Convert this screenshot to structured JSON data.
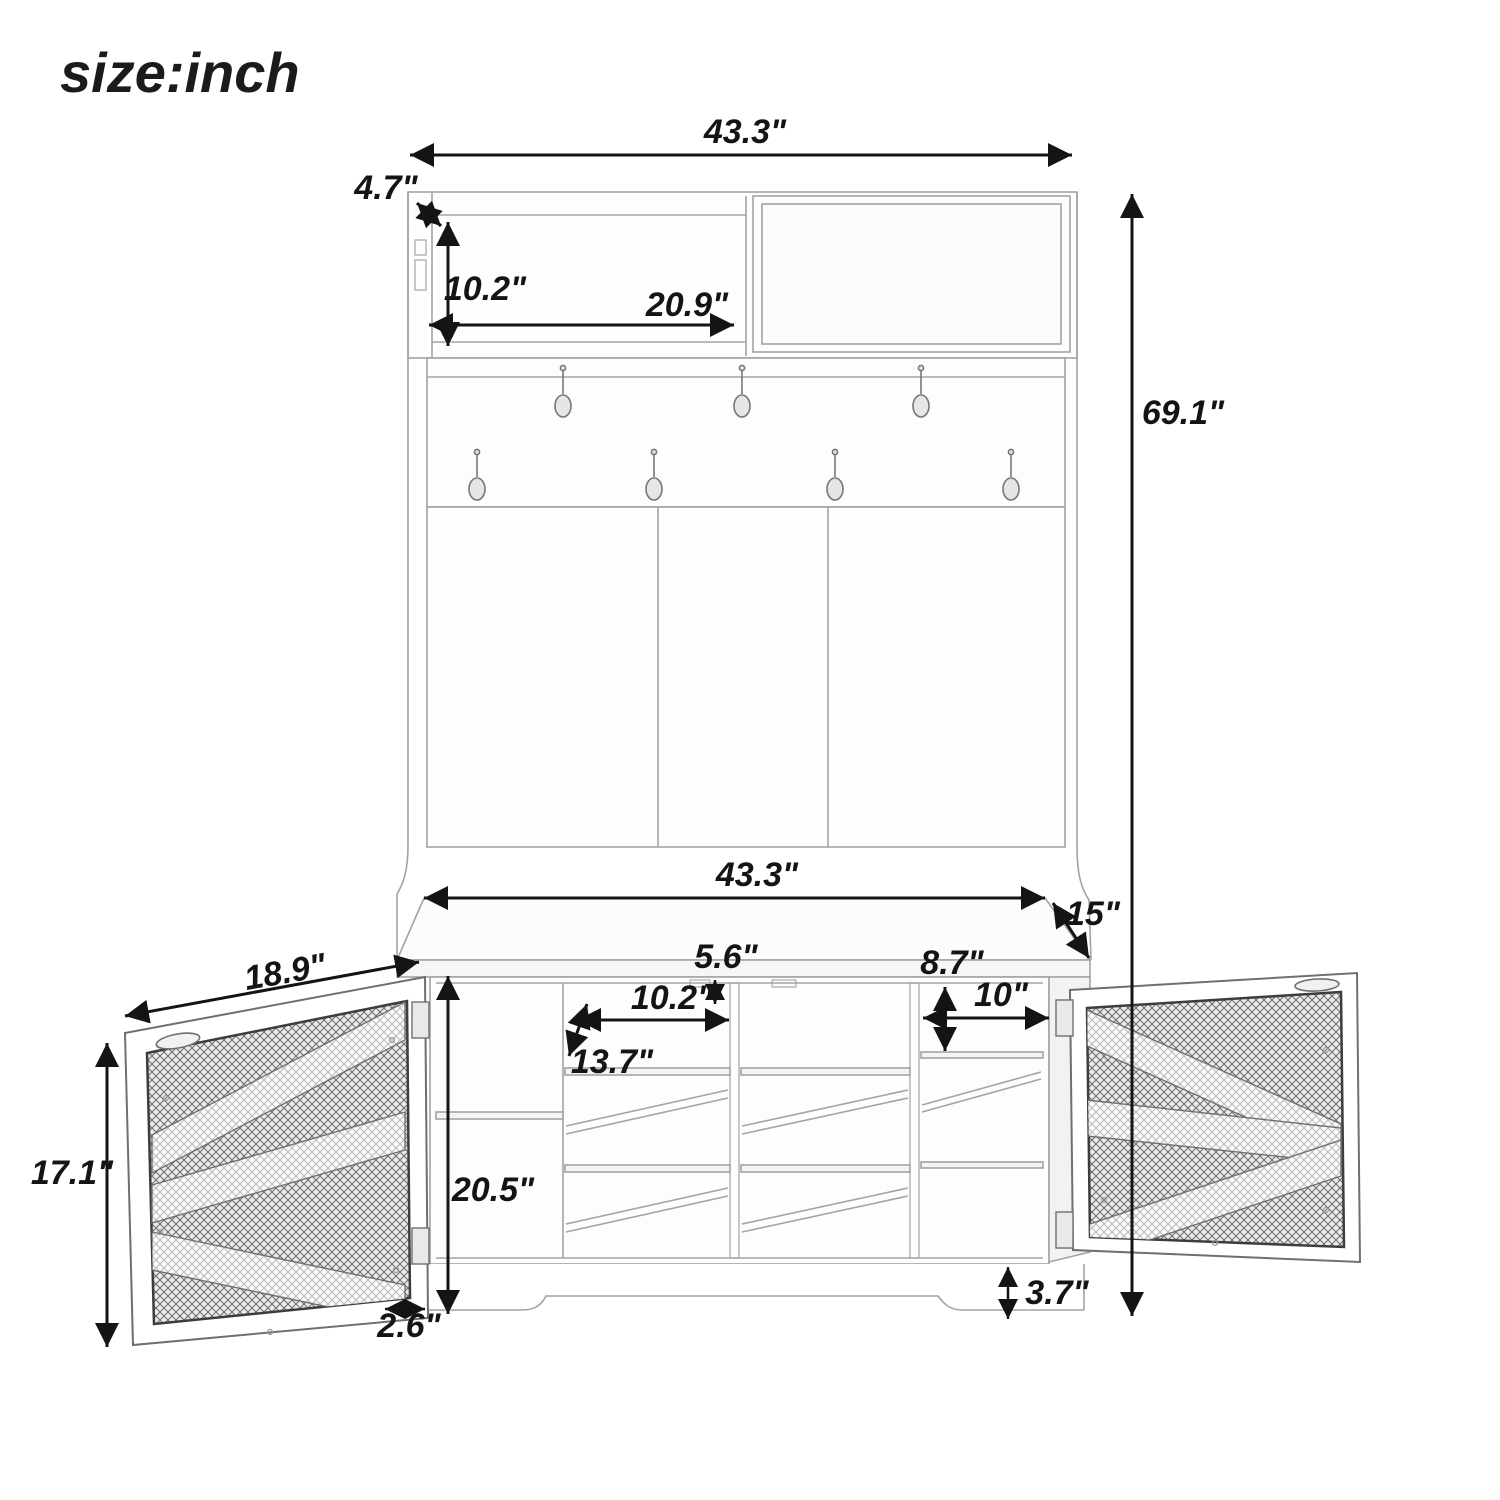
{
  "title": "size:inch",
  "colors": {
    "dimension_line": "#141414",
    "furniture_line": "#a3a3a3",
    "door_frame_line": "#5f5f5f",
    "mesh_dark": "#6a6a6a",
    "mesh_light": "#b8b8b8",
    "background": "#ffffff"
  },
  "dimensions": {
    "top_width": "43.3\"",
    "top_depth": "4.7\"",
    "shelf_height": "10.2\"",
    "shelf_width": "20.9\"",
    "total_height": "69.1\"",
    "bench_width": "43.3\"",
    "bench_depth": "15\"",
    "gap_height": "5.6\"",
    "cubby_width": "10.2\"",
    "cubby_depth": "13.7\"",
    "right_cubby_height": "8.7\"",
    "right_cubby_width": "10\"",
    "door_width": "18.9\"",
    "door_height": "17.1\"",
    "bench_height": "20.5\"",
    "base_inset": "2.6\"",
    "base_height": "3.7\""
  }
}
